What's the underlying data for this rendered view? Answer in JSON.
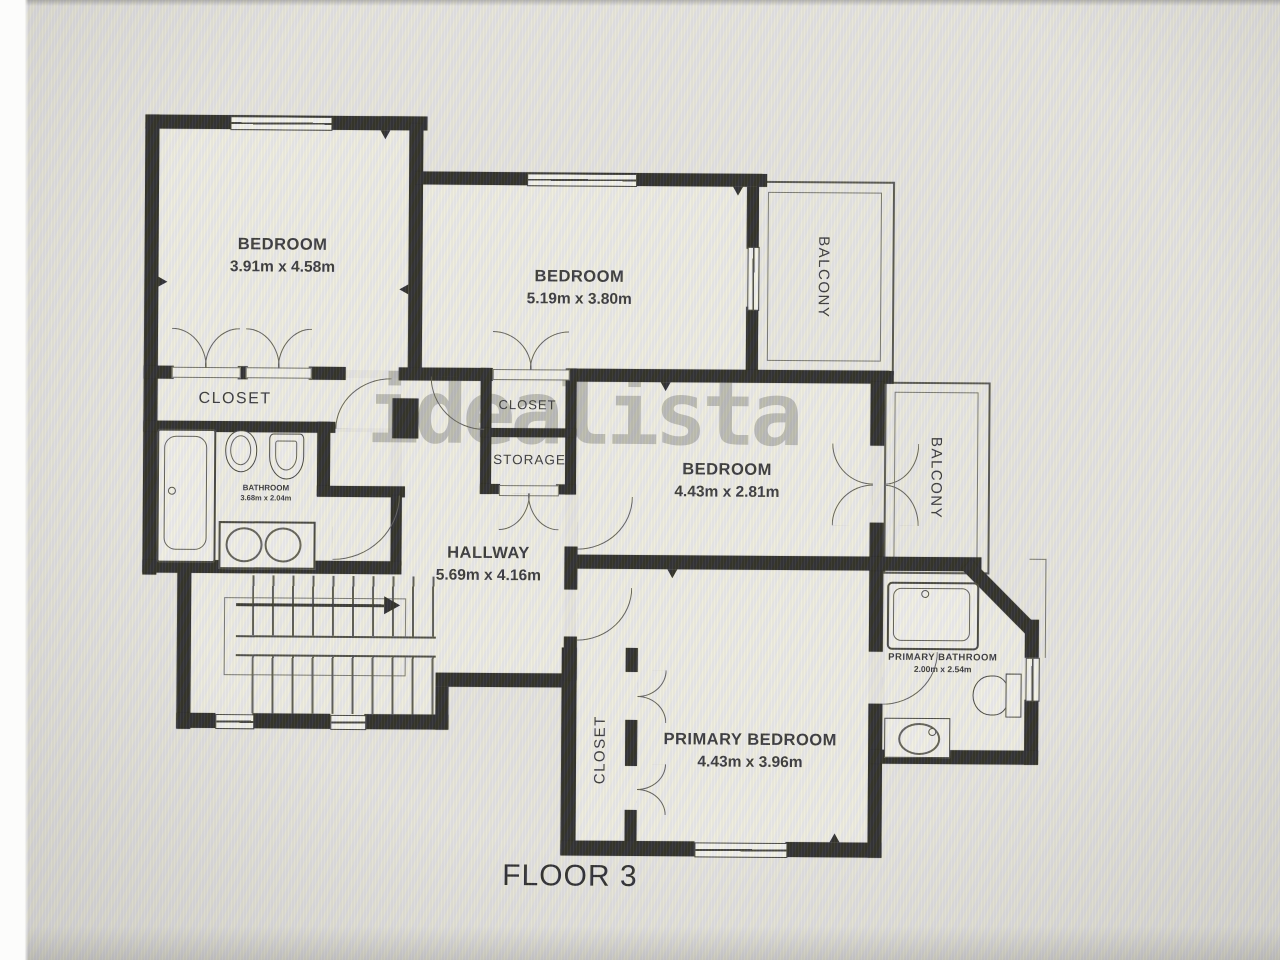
{
  "floor_label": {
    "text": "FLOOR 3"
  },
  "watermark": {
    "text": "idealista"
  },
  "rooms": {
    "bedroom1": {
      "name": "BEDROOM",
      "dims": "3.91m x 4.58m"
    },
    "bedroom2": {
      "name": "BEDROOM",
      "dims": "5.19m x 3.80m"
    },
    "bedroom3": {
      "name": "BEDROOM",
      "dims": "4.43m x 2.81m"
    },
    "primary_bedroom": {
      "name": "PRIMARY BEDROOM",
      "dims": "4.43m x 3.96m"
    },
    "hallway": {
      "name": "HALLWAY",
      "dims": "5.69m x 4.16m"
    },
    "bathroom": {
      "name": "BATHROOM",
      "dims": "3.68m x 2.04m"
    },
    "primary_bathroom": {
      "name": "PRIMARY BATHROOM",
      "dims": "2.00m x 2.54m"
    },
    "closet_left": {
      "name": "CLOSET"
    },
    "closet_center": {
      "name": "CLOSET"
    },
    "closet_primary": {
      "name": "CLOSET"
    },
    "storage": {
      "name": "STORAGE"
    },
    "balcony_top": {
      "name": "BALCONY"
    },
    "balcony_right": {
      "name": "BALCONY"
    }
  },
  "colors": {
    "wall": "#232321",
    "floor": "#f1f0ea",
    "background": "#e9e8e4",
    "text": "#2e2e32",
    "watermark": "#6c6c66"
  }
}
